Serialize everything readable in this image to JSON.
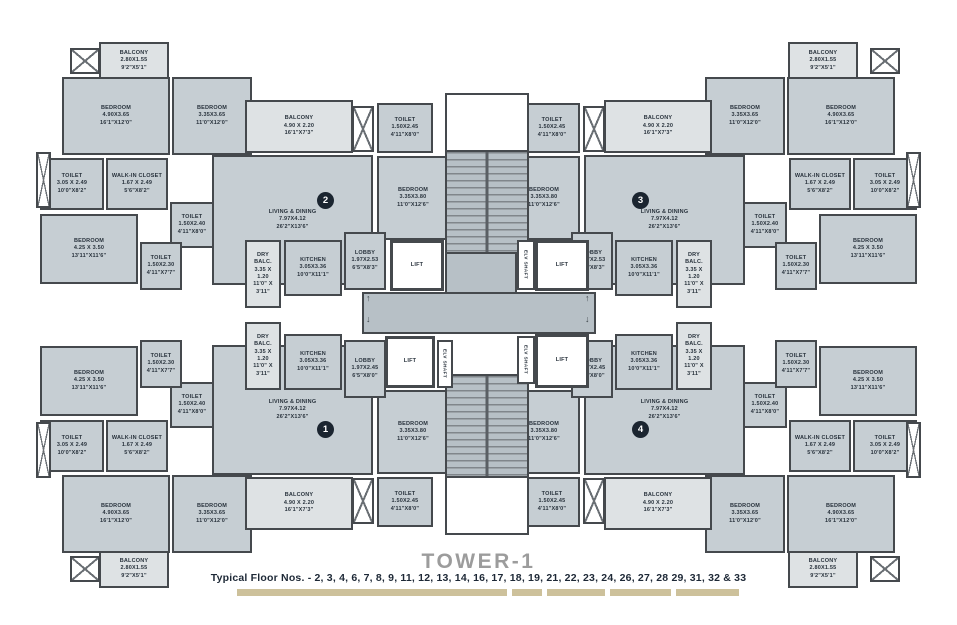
{
  "title": "TOWER-1",
  "caption": "Typical Floor Nos. - 2, 3, 4, 6, 7, 8, 9, 11, 12, 13, 14, 16, 17, 18, 19, 21, 22, 23, 24, 26, 27, 28 29, 31, 32 & 33",
  "units": [
    {
      "number": "1",
      "position": "bottom-left"
    },
    {
      "number": "2",
      "position": "top-left"
    },
    {
      "number": "3",
      "position": "top-right"
    },
    {
      "number": "4",
      "position": "bottom-right"
    }
  ],
  "rooms": {
    "balcony_small": {
      "lines": [
        "BALCONY",
        "2.80X1.55",
        "9'2\"X5'1\""
      ]
    },
    "bedroom_a": {
      "lines": [
        "BEDROOM",
        "4.90X3.65",
        "16'1\"X12'0\""
      ]
    },
    "bedroom_b": {
      "lines": [
        "BEDROOM",
        "3.35X3.65",
        "11'0\"X12'0\""
      ]
    },
    "toilet_big": {
      "lines": [
        "TOILET",
        "3.05 X 2.49",
        "10'0\"X8'2\""
      ]
    },
    "walkin": {
      "lines": [
        "WALK-IN CLOSET",
        "1.67 X 2.49",
        "5'6\"X8'2\""
      ]
    },
    "toilet_240": {
      "lines": [
        "TOILET",
        "1.50X2.40",
        "4'11\"X8'0\""
      ]
    },
    "bedroom_c": {
      "lines": [
        "BEDROOM",
        "4.25 X 3.50",
        "13'11\"X11'6\""
      ]
    },
    "toilet_230": {
      "lines": [
        "TOILET",
        "1.50X2.30",
        "4'11\"X7'7\""
      ]
    },
    "living": {
      "lines": [
        "LIVING & DINING",
        "7.97X4.12",
        "26'2\"X13'6\""
      ]
    },
    "balcony_big": {
      "lines": [
        "BALCONY",
        "4.90 X 2.20",
        "16'1\"X7'3\""
      ]
    },
    "toilet_245": {
      "lines": [
        "TOILET",
        "1.50X2.45",
        "4'11\"X8'0\""
      ]
    },
    "bedroom_d": {
      "lines": [
        "BEDROOM",
        "3.35X3.80",
        "11'0\"X12'6\""
      ]
    },
    "dry_balc": {
      "lines": [
        "DRY",
        "BALC.",
        "3.35 X",
        "1.20",
        "11'0\" X",
        "3'11\""
      ]
    },
    "kitchen": {
      "lines": [
        "KITCHEN",
        "3.05X3.36",
        "10'0\"X11'1\""
      ]
    },
    "lobby_top": {
      "lines": [
        "LOBBY",
        "1.97X2.53",
        "6'5\"X8'3\""
      ]
    },
    "lobby_bottom": {
      "lines": [
        "LOBBY",
        "1.97X2.45",
        "6'5\"X8'0\""
      ]
    }
  },
  "core": {
    "lift": "LIFT",
    "shaft": "ELV SHAFT",
    "arrow_up": "↑",
    "arrow_down": "↓"
  },
  "colors": {
    "wall": "#45494d",
    "room_fill": "#c6ced3",
    "balcony_fill": "#dee2e4",
    "core_fill": "#b7c0c6",
    "circle": "#1b2530",
    "title_gray": "#9c9c9c",
    "caption_navy": "#1d2836",
    "legend_tan": "#cdc19b"
  }
}
